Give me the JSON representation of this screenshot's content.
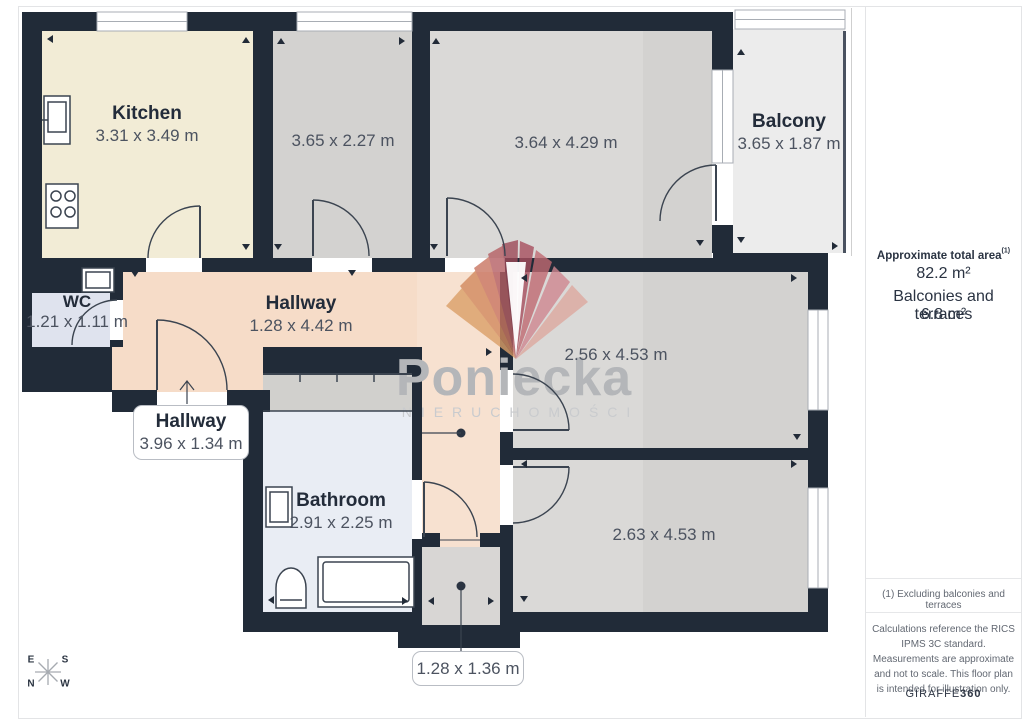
{
  "plan": {
    "rooms": {
      "kitchen": {
        "name": "Kitchen",
        "dims": "3.31 x 3.49 m"
      },
      "room_a": {
        "dims": "3.65 x 2.27 m"
      },
      "room_b": {
        "dims": "3.64 x 4.29 m"
      },
      "balcony": {
        "name": "Balcony",
        "dims": "3.65 x 1.87 m"
      },
      "wc": {
        "name": "WC",
        "dims": "1.21 x 1.11 m"
      },
      "hallway": {
        "name": "Hallway",
        "dims": "1.28 x 4.42 m"
      },
      "hallway2": {
        "name": "Hallway",
        "dims": "3.96 x 1.34 m"
      },
      "bathroom": {
        "name": "Bathroom",
        "dims": "2.91 x 2.25 m"
      },
      "room_c": {
        "dims": "2.56 x 4.53 m"
      },
      "room_d": {
        "dims": "2.63 x 4.53 m"
      },
      "vestibule": {
        "dims": "1.28 x 1.36 m"
      }
    },
    "compass": {
      "n": "N",
      "s": "S",
      "e": "E",
      "w": "W"
    }
  },
  "watermark": {
    "brand": "Poniecka",
    "subtitle": "NIERUCHOMOŚCI"
  },
  "sidebar": {
    "total_area_label": "Approximate total area",
    "total_area_sup": "(1)",
    "total_area_value": "82.2 m²",
    "balconies_label": "Balconies and terraces",
    "balconies_value": "6.8 m²",
    "footnote": "(1) Excluding balconies and terraces",
    "disclaimer": "Calculations reference the RICS IPMS 3C standard. Measurements are approximate and not to scale. This floor plan is intended for illustration only.",
    "brand_normal": "GIRAFFE",
    "brand_bold": "360"
  },
  "colors": {
    "wall": "#212b38",
    "kitchen": "#f2ecd6",
    "gray_room": "#d3d2d0",
    "hallway": "#f6dcc8",
    "bathroom": "#e9edf4",
    "wc": "#dfe3ee",
    "balcony": "#ececec",
    "logo_left": "#db9f68",
    "logo_center": "#9e4a58"
  }
}
